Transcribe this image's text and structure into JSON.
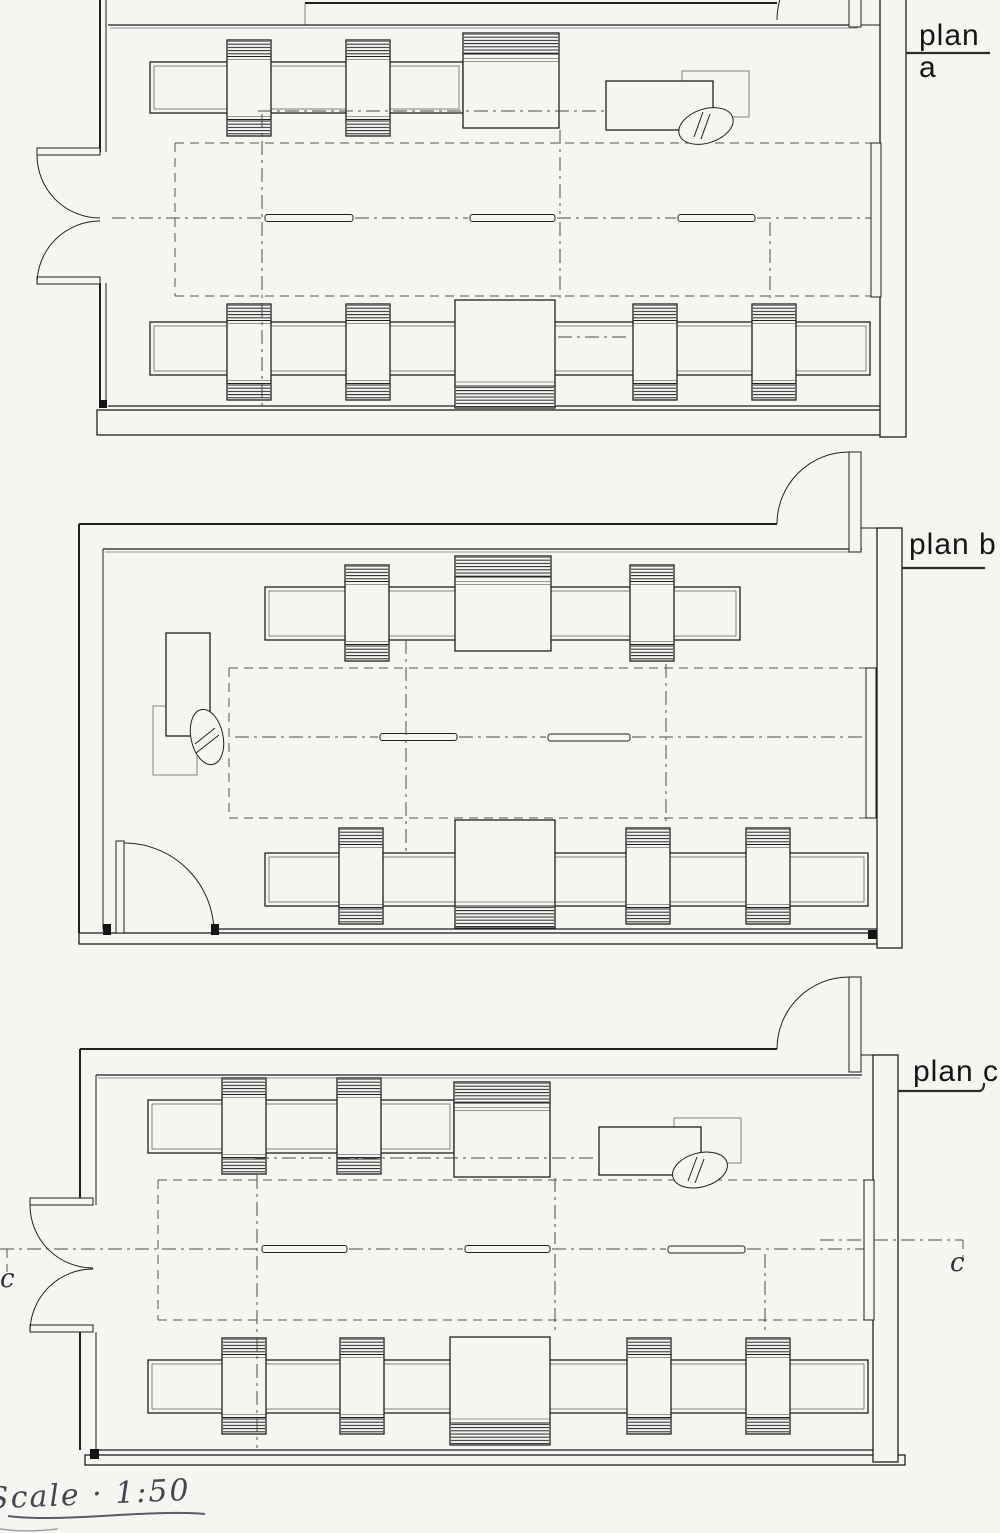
{
  "sheet": {
    "background": "#f6f5f2",
    "ink": "#1f1f1f"
  },
  "plans": [
    {
      "id": "a",
      "label": "plan a"
    },
    {
      "id": "b",
      "label": "plan b"
    },
    {
      "id": "c",
      "label": "plan c"
    }
  ],
  "section": {
    "left_label": "c",
    "right_label": "c"
  },
  "scale_note": {
    "text": "Scale · 1:50"
  }
}
